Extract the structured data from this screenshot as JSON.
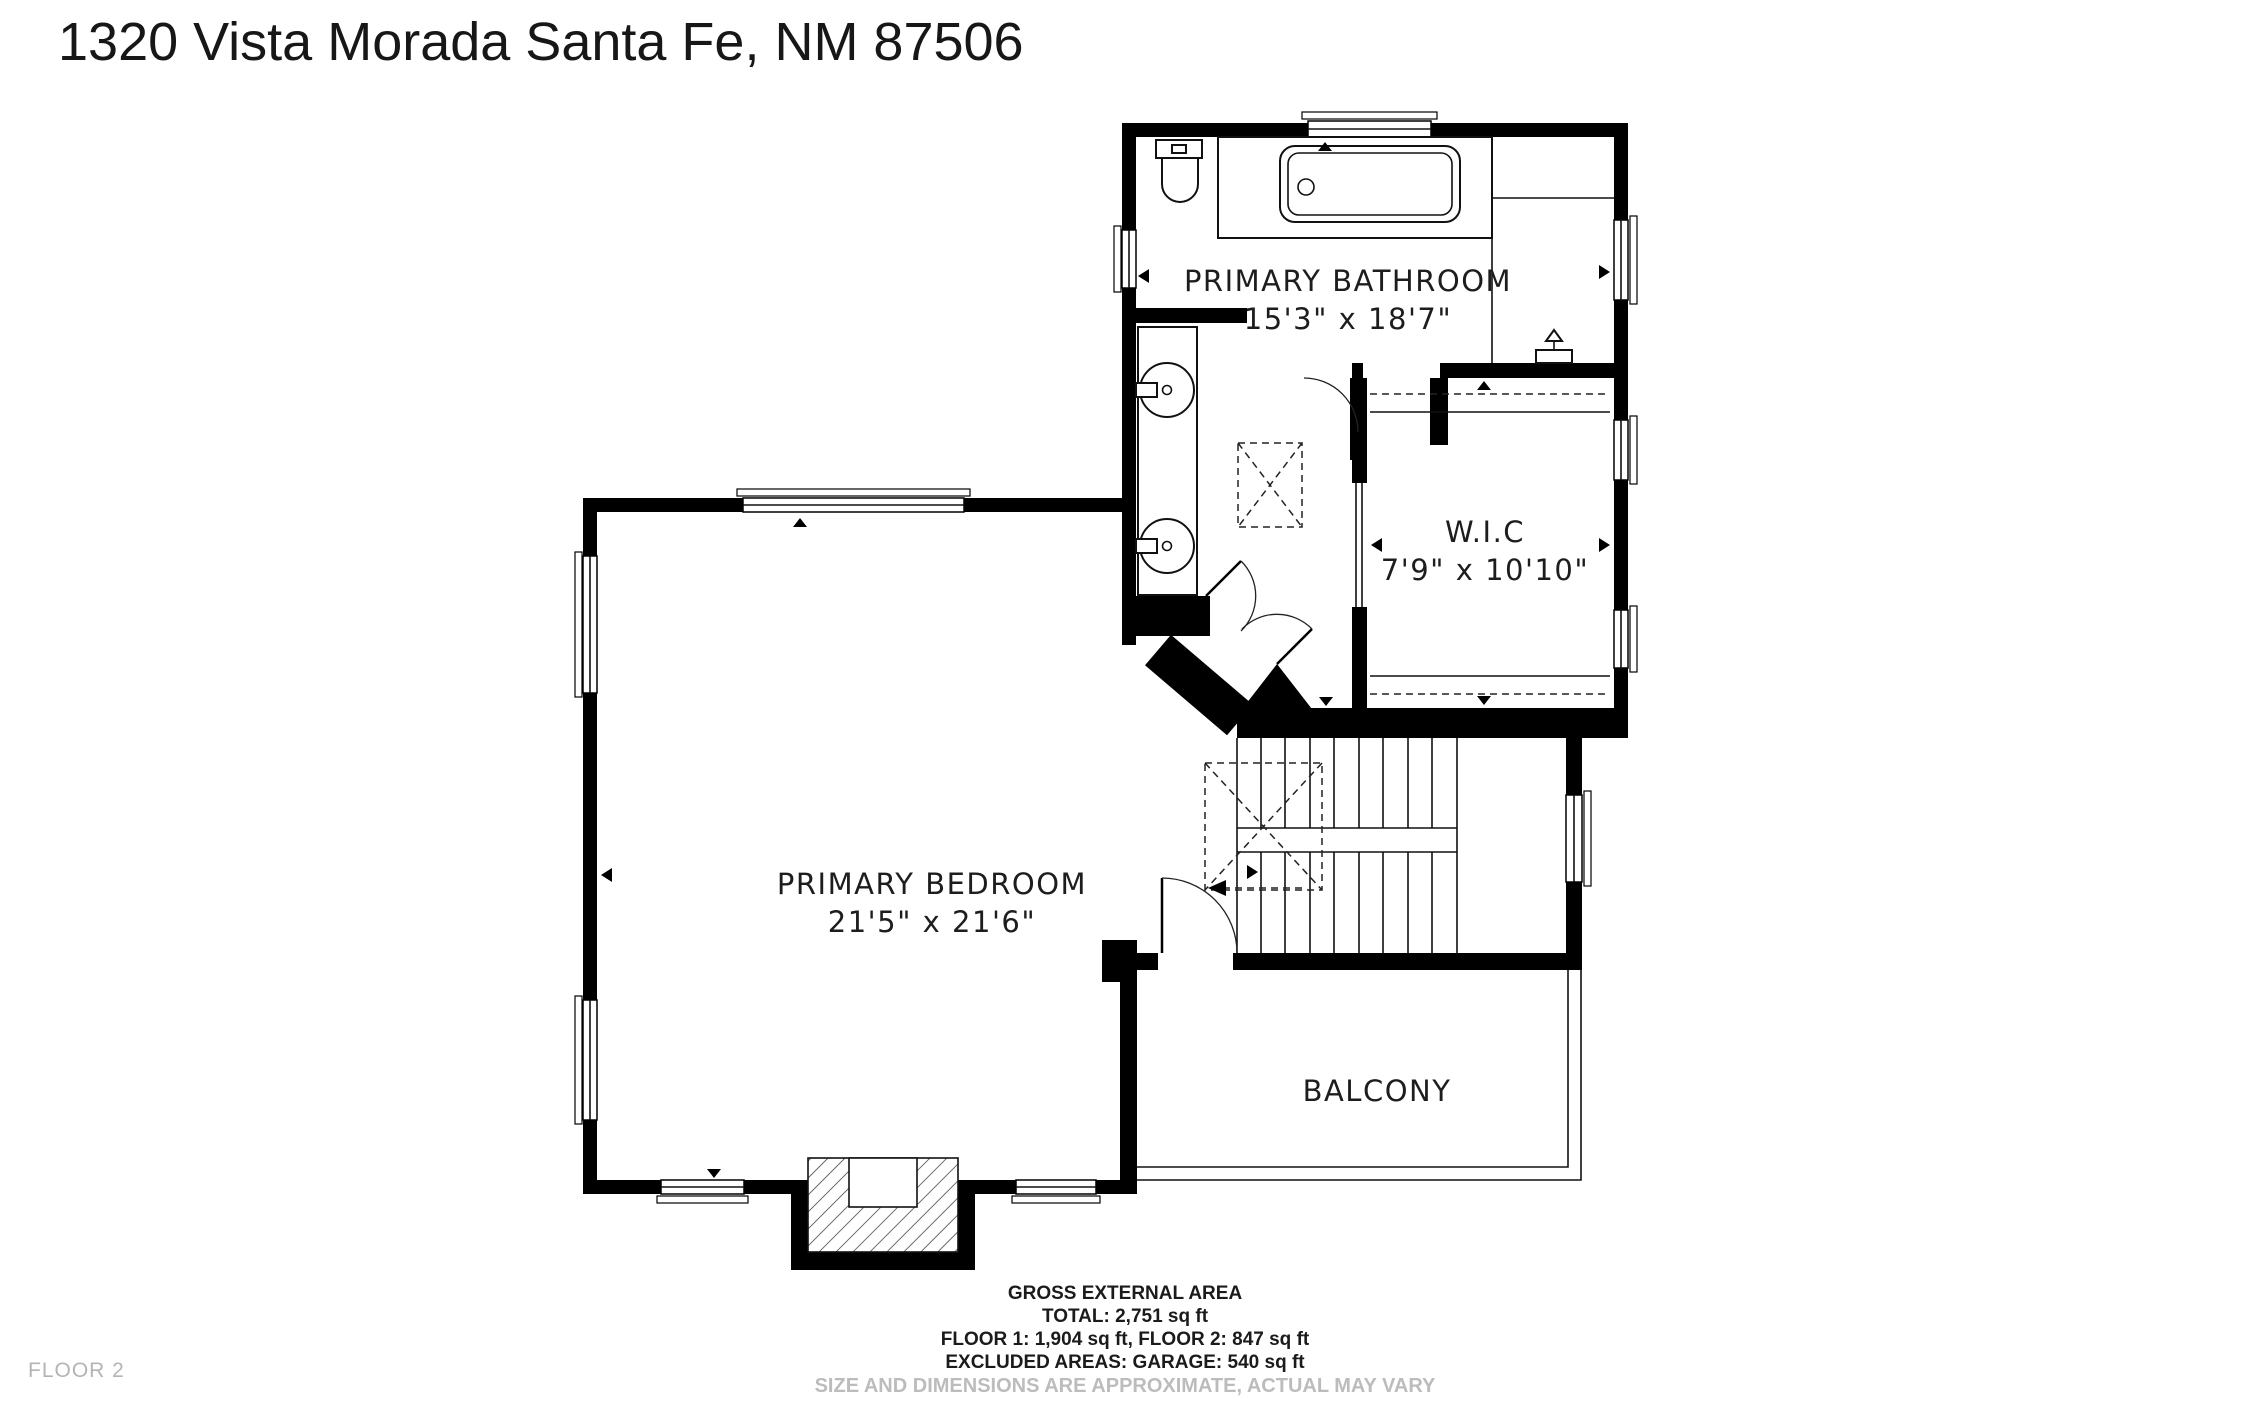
{
  "title": "1320 Vista Morada Santa Fe, NM 87506",
  "floor_label": "FLOOR 2",
  "rooms": {
    "bathroom": {
      "name": "PRIMARY BATHROOM",
      "dims": "15'3\" x 18'7\""
    },
    "wic": {
      "name": "W.I.C",
      "dims": "7'9\" x 10'10\""
    },
    "bedroom": {
      "name": "PRIMARY BEDROOM",
      "dims": "21'5\" x 21'6\""
    },
    "balcony": {
      "name": "BALCONY"
    }
  },
  "footer": {
    "heading": "GROSS EXTERNAL AREA",
    "total": "TOTAL: 2,751 sq ft",
    "floors": "FLOOR 1: 1,904 sq ft, FLOOR 2: 847 sq ft",
    "excluded": "EXCLUDED AREAS: GARAGE: 540 sq ft",
    "disclaimer": "SIZE AND DIMENSIONS ARE APPROXIMATE, ACTUAL MAY VARY"
  },
  "colors": {
    "wall": "#000000",
    "background": "#ffffff",
    "muted_text": "#bcbcbc"
  }
}
